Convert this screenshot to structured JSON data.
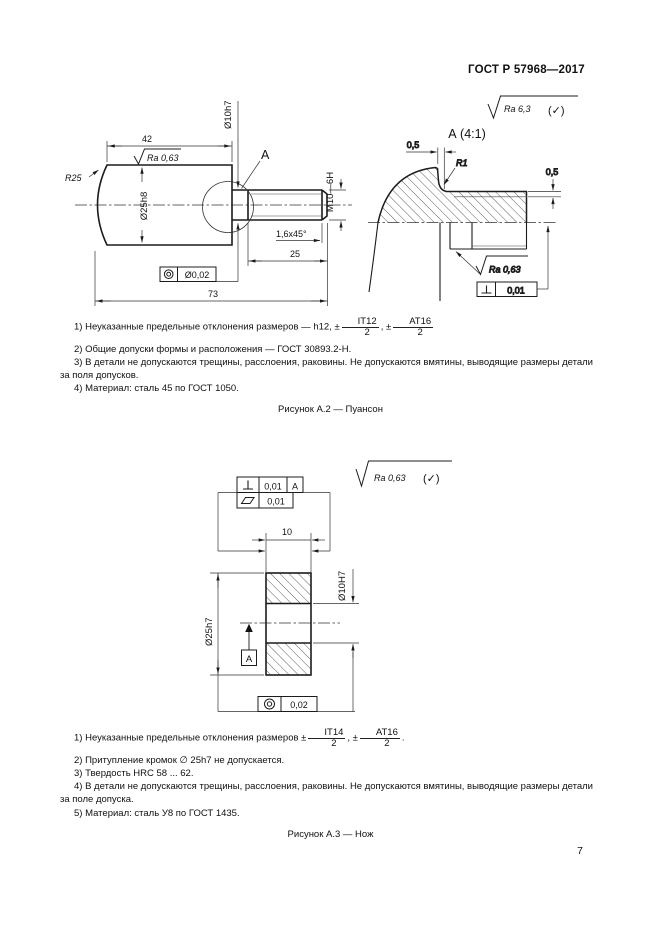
{
  "page": {
    "header": "ГОСТ Р 57968—2017",
    "number": "7"
  },
  "fig_a2": {
    "caption": "Рисунок А.2 — Пуансон",
    "finish": {
      "value": "Ra 6,3",
      "check": "(✓)"
    },
    "dims": {
      "len42": "42",
      "ra": "Ra 0,63",
      "r25": "R25",
      "d25h8": "Ø25h8",
      "detail_ref": "А",
      "d10h7": "Ø10h7",
      "thread": "M10—6H",
      "chamfer": "1,6x45°",
      "len25": "25",
      "len73": "73",
      "coax": "Ø0,02"
    },
    "detail": {
      "title": "А (4:1)",
      "w05": "0,5",
      "r1": "R1",
      "h05": "0,5",
      "ra": "Ra 0,63",
      "perp": "0,01"
    },
    "notes": {
      "n1_pre": "1) Неуказанные предельные отклонения размеров — h12, ±",
      "n1_f1n": "IT12",
      "n1_f1d": "2",
      "n1_mid": ", ±",
      "n1_f2n": "АТ16",
      "n1_f2d": "2",
      "n2": "2) Общие допуски формы и расположения — ГОСТ 30893.2-H.",
      "n3": "3) В детали не допускаются трещины, расслоения, раковины. Не допускаются вмятины, выводящие размеры детали за поля допусков.",
      "n4": "4) Материал: сталь 45 по ГОСТ 1050."
    }
  },
  "fig_a3": {
    "caption": "Рисунок А.3 — Нож",
    "finish": {
      "value": "Ra 0,63",
      "check": "(✓)"
    },
    "frames": {
      "perp": "0,01",
      "datum_ref": "А",
      "flat": "0,01",
      "coax": "0,02"
    },
    "dims": {
      "w10": "10",
      "d10H7": "Ø10H7",
      "d25h7": "Ø25h7",
      "datum": "А"
    },
    "notes": {
      "n1_pre": "1) Неуказанные предельные отклонения размеров ±",
      "n1_f1n": "IT14",
      "n1_f1d": "2",
      "n1_mid": ", ±",
      "n1_f2n": "АТ16",
      "n1_f2d": "2",
      "n1_end": ".",
      "n2": "2) Притупление кромок ∅ 25h7 не допускается.",
      "n3": "3) Твердость HRC 58 ... 62.",
      "n4": "4) В детали не допускаются трещины, расслоения, раковины. Не допускаются вмятины, выводящие размеры детали за поле допуска.",
      "n5": "5) Материал: сталь У8 по ГОСТ 1435."
    }
  }
}
